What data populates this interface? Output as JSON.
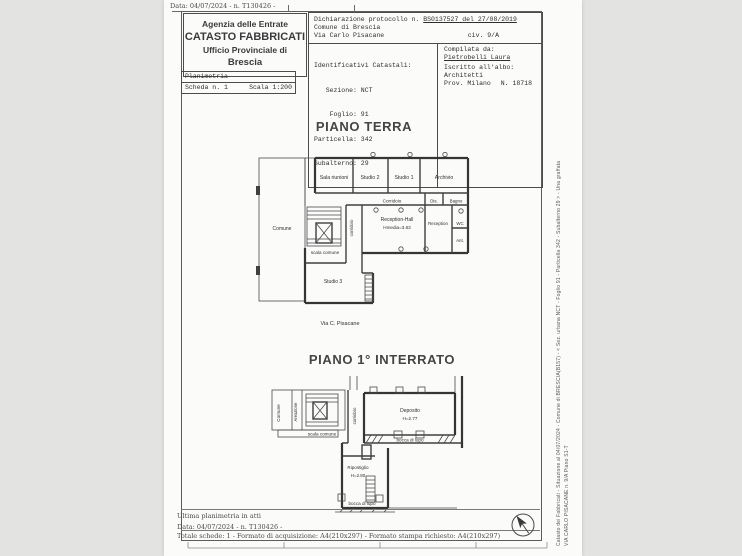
{
  "document": {
    "top_note": "Data: 04/07/2024 - n. T130426 -",
    "colors": {
      "paper": "#fbfbfa",
      "background": "#e3e3e2",
      "ink": "#3a3a3a"
    }
  },
  "header": {
    "agency": {
      "line1": "Agenzia delle Entrate",
      "line2": "CATASTO FABBRICATI",
      "line3": "Ufficio Provinciale di",
      "line4": "Brescia"
    },
    "planimetria_box": {
      "title": "Planimetria",
      "scheda": "Scheda n. 1",
      "scala": "Scala 1:200"
    },
    "declaration": {
      "label": "Dichiarazione protocollo n.",
      "value": "BS0137527 del 27/08/2019",
      "comune": "Comune di Brescia",
      "street": "Via Carlo Pisacane",
      "civic": "civ. 9/A"
    },
    "identificativi": {
      "title": "Identificativi Catastali:",
      "rows": [
        "   Sezione: NCT",
        "    Foglio: 91",
        "Particella: 342",
        "Subalterno: 29"
      ]
    },
    "compiler": {
      "label": "Compilata da:",
      "name": "Pietrobelli Laura",
      "albo_label": "Iscritto all'albo:",
      "albo": "Architetti",
      "prov": "Prov. Milano",
      "number": "N. 18718"
    }
  },
  "plans": {
    "terra": {
      "title": "PIANO TERRA",
      "street": "Via C. Pisacane",
      "labels": {
        "sala_riunioni": "Sala riunioni",
        "studio2": "Studio 2",
        "studio1": "Studio 1",
        "archivio": "Archivio",
        "corridoio": "Corridoio",
        "dis": "Dis.",
        "bagno": "Bagno",
        "reception_hall": "Reception-Hall",
        "reception_hall_h": "Hmedia=3.63",
        "reception": "Reception",
        "wc": "WC",
        "ant": "Ant.",
        "comune": "Comune",
        "scala_comune": "scala comune",
        "corridoio_v": "corridoio",
        "studio3": "Studio 3"
      }
    },
    "interrato": {
      "title": "PIANO 1° INTERRATO",
      "labels": {
        "comune": "Comune",
        "areazione": "Areazione",
        "scala_comune": "scala comune",
        "corridoio": "corridoio",
        "deposito": "Deposito",
        "deposito_h": "H=2.77",
        "bocca_di_lupo_1": "bocca di lupo",
        "ripostiglio": "Ripostiglio",
        "ripostiglio_h": "H=2.80",
        "bocca_di_lupo_2": "bocca di lupo"
      }
    }
  },
  "footer": {
    "line1": "Ultima planimetria in atti",
    "line2": "Data: 04/07/2024 - n. T130426 -",
    "line3": "Totale schede: 1 - Formato di acquisizione: A4(210x297) - Formato stampa richiesto: A4(210x297)"
  },
  "side_text": {
    "line1": "Catasto dei Fabbricati - Situazione al 04/07/2024 - Comune di BRESCIA(B157) - < Sez. urbana NCT - Foglio 91 - Particella 342 - Subalterno 29 > - Una graffata",
    "line2": "VIA CARLO PISACANE n. 9/A Piano S1-T"
  }
}
